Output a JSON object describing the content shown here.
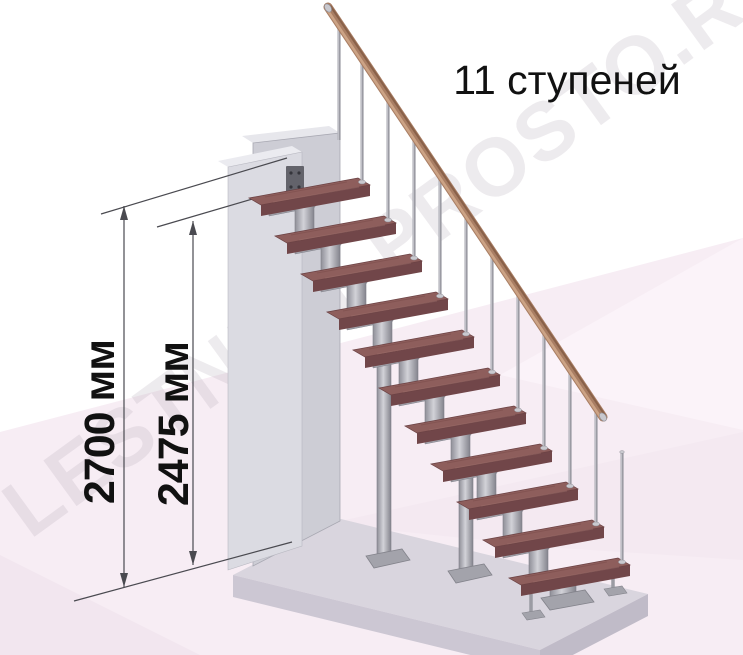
{
  "title": {
    "text": "11 ступеней"
  },
  "watermark": {
    "text": "LESTNICY-PROSTO.RU"
  },
  "dimensions": {
    "total_height": {
      "label": "2700 мм"
    },
    "to_top_step": {
      "label": "2475 мм"
    }
  },
  "stairs": {
    "steps_count": 11
  },
  "colors": {
    "tread_top": "#8e5e5c",
    "tread_front": "#714649",
    "tread_side": "#5d3a3d",
    "tread_grain_dark": "#7b4c4b",
    "tread_grain_light": "#9c6e6a",
    "metal_light": "#d2d2d8",
    "metal_mid": "#a0a0a8",
    "metal_dark": "#84848d",
    "baluster": "#9b9ba3",
    "handrail": "#a97e64",
    "handrail_highlight": "#d3aa8b",
    "handrail_shadow": "#7c553f",
    "wall_front": "#dbdbe2",
    "wall_back": "#cdcdd5",
    "platform_top": "#d9d5de",
    "platform_front": "#ccc7d3",
    "platform_side": "#c0bbc8",
    "background_pink": "#f7edf4",
    "dimension_line": "#4a4a50",
    "text": "#111111"
  }
}
